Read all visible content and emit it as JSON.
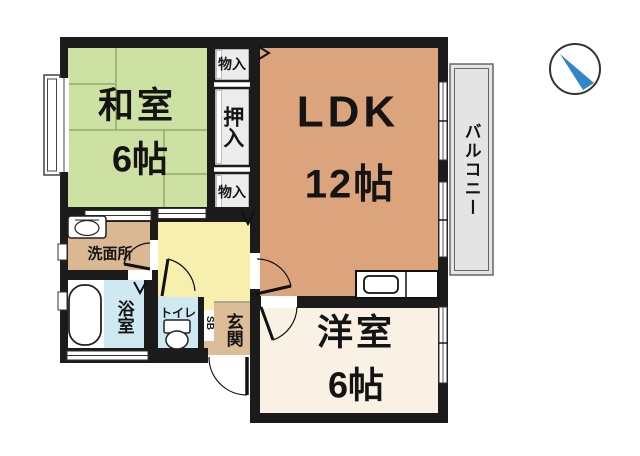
{
  "plan": {
    "rooms": {
      "washitsu": {
        "label": "和室",
        "size": "6帖"
      },
      "ldk": {
        "label": "LDK",
        "size": "12帖"
      },
      "youshitsu": {
        "label": "洋室",
        "size": "6帖"
      },
      "balcony": {
        "label": "バルコニー"
      },
      "washroom": {
        "label": "洗面所"
      },
      "bathroom": {
        "label": "浴室"
      },
      "toilet": {
        "label": "トイレ"
      },
      "entrance": {
        "label": "玄関"
      },
      "shoe_box": {
        "label": "SB"
      },
      "storage_top": {
        "label": "物入"
      },
      "closet": {
        "label": "押入"
      },
      "storage_bottom": {
        "label": "物入"
      }
    },
    "colors": {
      "wall": "#1b1b1b",
      "washitsu": "#cde2a2",
      "tatami_line": "#93a96c",
      "ldk": "#dba47d",
      "youshitsu": "#f9f1e4",
      "hallway": "#f6efae",
      "washroom": "#d9b893",
      "entrance": "#ddbc98",
      "shoe_box": "#d2aa7e",
      "water_blue": "#cfe9f3",
      "closet_fill": "#ececec",
      "balcony_fill": "#e4e4e4",
      "compass_blue": "#2f86c9"
    },
    "icons": {
      "compass": "north-arrow"
    }
  }
}
